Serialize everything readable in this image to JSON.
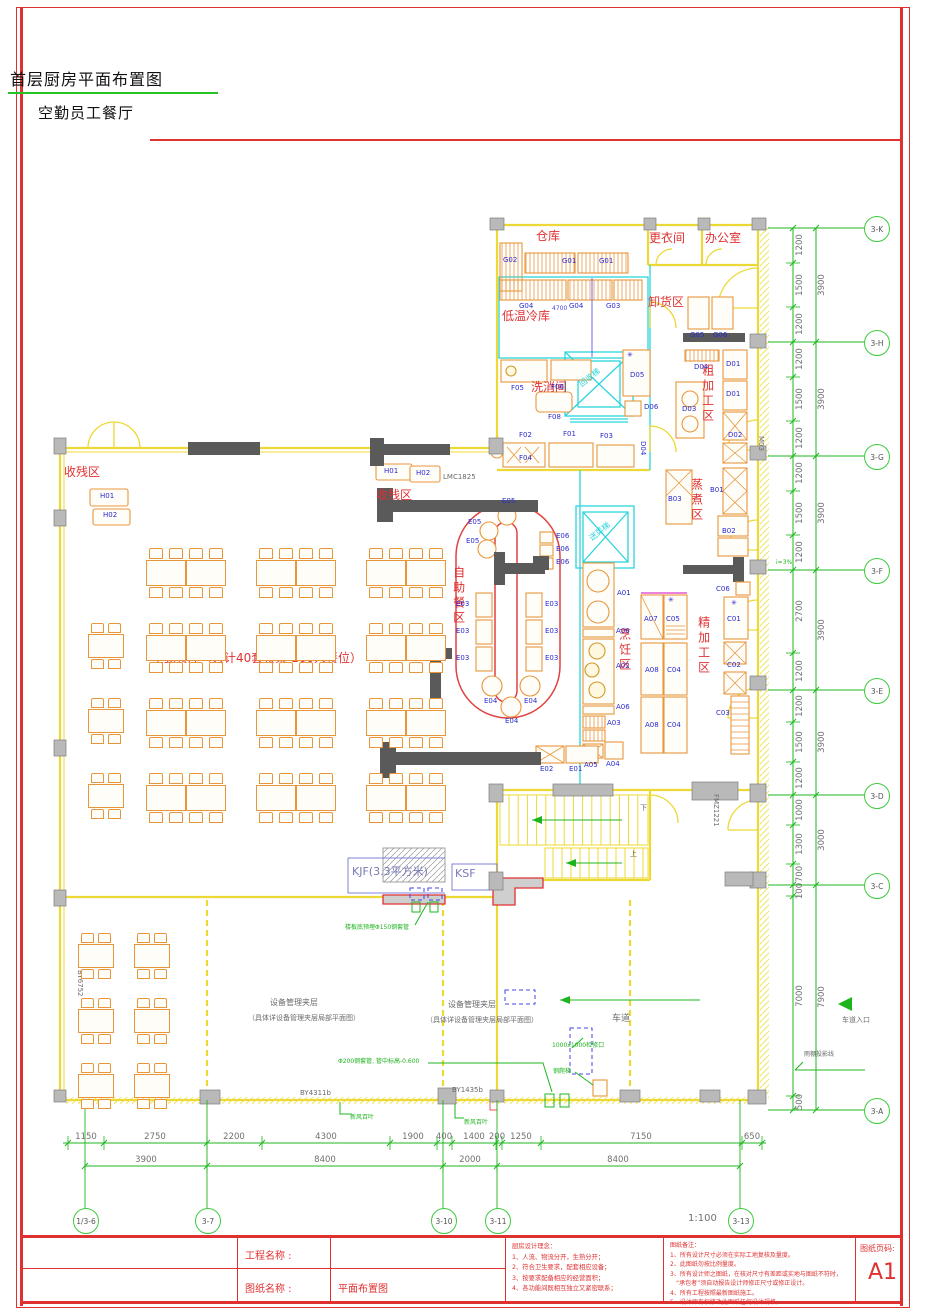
{
  "page": {
    "title": "首层厨房平面布置图",
    "subtitle": "空勤员工餐厅",
    "scale": "1:100"
  },
  "colors": {
    "wall": "#ecd936",
    "partition": "#2ad5dd",
    "furniture": "#e8963c",
    "zone_text": "#e03131",
    "code_text": "#2a2ad0",
    "dims": "#1db51d",
    "frame": "#e03131"
  },
  "zones": [
    {
      "label": "仓库",
      "x": 536,
      "y": 230,
      "dir": "h"
    },
    {
      "label": "更衣间",
      "x": 649,
      "y": 232,
      "dir": "h"
    },
    {
      "label": "办公室",
      "x": 705,
      "y": 232,
      "dir": "h"
    },
    {
      "label": "卸货区",
      "x": 648,
      "y": 296,
      "dir": "h"
    },
    {
      "label": "低温冷库",
      "x": 502,
      "y": 310,
      "dir": "h"
    },
    {
      "label": "洗消间",
      "x": 531,
      "y": 381,
      "dir": "h"
    },
    {
      "label": "收残区",
      "x": 64,
      "y": 466,
      "dir": "h"
    },
    {
      "label": "收残区",
      "x": 376,
      "y": 489,
      "dir": "h"
    },
    {
      "label": "自助餐区",
      "x": 452,
      "y": 566,
      "dir": "v"
    },
    {
      "label": "烹饪区",
      "x": 618,
      "y": 628,
      "dir": "v"
    },
    {
      "label": "蒸煮区",
      "x": 690,
      "y": 478,
      "dir": "v"
    },
    {
      "label": "精加工区",
      "x": 697,
      "y": 616,
      "dir": "v"
    },
    {
      "label": "粗加工区",
      "x": 701,
      "y": 364,
      "dir": "v"
    },
    {
      "label": "空勤餐厅（共计40套餐桌  160人餐位）",
      "x": 152,
      "y": 652,
      "dir": "h"
    }
  ],
  "equipment_codes": [
    {
      "code": "G02",
      "x": 503,
      "y": 257
    },
    {
      "code": "G01",
      "x": 562,
      "y": 258
    },
    {
      "code": "G01",
      "x": 599,
      "y": 258
    },
    {
      "code": "G04",
      "x": 519,
      "y": 303
    },
    {
      "code": "G04",
      "x": 569,
      "y": 303
    },
    {
      "code": "G03",
      "x": 606,
      "y": 303
    },
    {
      "code": "G05",
      "x": 690,
      "y": 332
    },
    {
      "code": "G06",
      "x": 713,
      "y": 332
    },
    {
      "code": "F05",
      "x": 511,
      "y": 385
    },
    {
      "code": "F06",
      "x": 551,
      "y": 384
    },
    {
      "code": "F08",
      "x": 548,
      "y": 414
    },
    {
      "code": "F02",
      "x": 519,
      "y": 432
    },
    {
      "code": "F01",
      "x": 563,
      "y": 431
    },
    {
      "code": "F03",
      "x": 600,
      "y": 433
    },
    {
      "code": "F04",
      "x": 519,
      "y": 455
    },
    {
      "code": "D05",
      "x": 630,
      "y": 372
    },
    {
      "code": "D06",
      "x": 644,
      "y": 404
    },
    {
      "code": "D04",
      "x": 694,
      "y": 364
    },
    {
      "code": "D03",
      "x": 682,
      "y": 406
    },
    {
      "code": "D01",
      "x": 726,
      "y": 361
    },
    {
      "code": "D01",
      "x": 726,
      "y": 391
    },
    {
      "code": "D02",
      "x": 728,
      "y": 432
    },
    {
      "code": "D04",
      "x": 639,
      "y": 441,
      "dir": "v"
    },
    {
      "code": "B03",
      "x": 668,
      "y": 496
    },
    {
      "code": "B01",
      "x": 710,
      "y": 487
    },
    {
      "code": "B02",
      "x": 722,
      "y": 528
    },
    {
      "code": "C06",
      "x": 716,
      "y": 586
    },
    {
      "code": "C01",
      "x": 727,
      "y": 616
    },
    {
      "code": "C02",
      "x": 727,
      "y": 662
    },
    {
      "code": "C03",
      "x": 716,
      "y": 710
    },
    {
      "code": "C05",
      "x": 666,
      "y": 616
    },
    {
      "code": "A07",
      "x": 644,
      "y": 616
    },
    {
      "code": "A08",
      "x": 645,
      "y": 667
    },
    {
      "code": "C04",
      "x": 667,
      "y": 667
    },
    {
      "code": "A08",
      "x": 645,
      "y": 722
    },
    {
      "code": "C04",
      "x": 667,
      "y": 722
    },
    {
      "code": "A01",
      "x": 617,
      "y": 590
    },
    {
      "code": "A06",
      "x": 616,
      "y": 628
    },
    {
      "code": "A02",
      "x": 616,
      "y": 663
    },
    {
      "code": "A06",
      "x": 616,
      "y": 704
    },
    {
      "code": "A03",
      "x": 607,
      "y": 720
    },
    {
      "code": "A05",
      "x": 584,
      "y": 762
    },
    {
      "code": "A04",
      "x": 606,
      "y": 761
    },
    {
      "code": "E05",
      "x": 502,
      "y": 498
    },
    {
      "code": "E05",
      "x": 468,
      "y": 519
    },
    {
      "code": "E05",
      "x": 466,
      "y": 538
    },
    {
      "code": "E06",
      "x": 556,
      "y": 533
    },
    {
      "code": "E06",
      "x": 556,
      "y": 546
    },
    {
      "code": "E06",
      "x": 556,
      "y": 559
    },
    {
      "code": "E03",
      "x": 456,
      "y": 601
    },
    {
      "code": "E03",
      "x": 456,
      "y": 628
    },
    {
      "code": "E03",
      "x": 456,
      "y": 655
    },
    {
      "code": "E03",
      "x": 545,
      "y": 601
    },
    {
      "code": "E03",
      "x": 545,
      "y": 628
    },
    {
      "code": "E03",
      "x": 545,
      "y": 655
    },
    {
      "code": "E04",
      "x": 484,
      "y": 698
    },
    {
      "code": "E04",
      "x": 524,
      "y": 698
    },
    {
      "code": "E04",
      "x": 505,
      "y": 718
    },
    {
      "code": "E02",
      "x": 540,
      "y": 766
    },
    {
      "code": "E01",
      "x": 569,
      "y": 766
    },
    {
      "code": "H01",
      "x": 100,
      "y": 493
    },
    {
      "code": "H02",
      "x": 103,
      "y": 512
    },
    {
      "code": "H01",
      "x": 384,
      "y": 468
    },
    {
      "code": "H02",
      "x": 416,
      "y": 470
    }
  ],
  "annotations": [
    {
      "t": "LMC1825",
      "x": 443,
      "y": 474,
      "c": "#6a6a6a",
      "s": 7
    },
    {
      "t": "M03",
      "x": 757,
      "y": 436,
      "c": "#6a6a6a",
      "s": 7,
      "dir": "v"
    },
    {
      "t": "FMZ1221",
      "x": 712,
      "y": 794,
      "c": "#6a6a6a",
      "s": 7,
      "dir": "v"
    },
    {
      "t": "BY6752",
      "x": 76,
      "y": 970,
      "c": "#6a6a6a",
      "s": 7,
      "dir": "v"
    },
    {
      "t": "BY4311b",
      "x": 300,
      "y": 1090,
      "c": "#6a6a6a",
      "s": 7
    },
    {
      "t": "BY1435b",
      "x": 452,
      "y": 1087,
      "c": "#6a6a6a",
      "s": 7
    },
    {
      "t": "KJF(3.3平方米)",
      "x": 352,
      "y": 866,
      "c": "#7878b8",
      "s": 11
    },
    {
      "t": "KSF",
      "x": 455,
      "y": 868,
      "c": "#7878b8",
      "s": 11
    },
    {
      "t": "回收梯",
      "x": 578,
      "y": 374,
      "c": "#2ad5dd",
      "s": 8,
      "rot": -38
    },
    {
      "t": "送菜梯",
      "x": 588,
      "y": 528,
      "c": "#2ad5dd",
      "s": 8,
      "rot": -38
    },
    {
      "t": "设备管理夹层",
      "x": 270,
      "y": 999,
      "c": "#6a6a6a",
      "s": 8
    },
    {
      "t": "（具体详设备管理夹层局部平面图）",
      "x": 248,
      "y": 1015,
      "c": "#6a6a6a",
      "s": 7
    },
    {
      "t": "设备管理夹层",
      "x": 448,
      "y": 1001,
      "c": "#6a6a6a",
      "s": 8
    },
    {
      "t": "（具体详设备管理夹层局部平面图）",
      "x": 426,
      "y": 1017,
      "c": "#6a6a6a",
      "s": 7
    },
    {
      "t": "车道",
      "x": 612,
      "y": 1015,
      "c": "#6a6a6a",
      "s": 9
    },
    {
      "t": "车道入口",
      "x": 842,
      "y": 1017,
      "c": "#6a6a6a",
      "s": 7
    },
    {
      "t": "雨棚投影线",
      "x": 804,
      "y": 1052,
      "c": "#6a6a6a",
      "s": 6
    },
    {
      "t": "楼板底预埋Φ150钢套管",
      "x": 345,
      "y": 925,
      "c": "#1db51d",
      "s": 6
    },
    {
      "t": "Φ200钢套管, 管中标高-0.600",
      "x": 338,
      "y": 1059,
      "c": "#1db51d",
      "s": 6
    },
    {
      "t": "1000x1000检修口",
      "x": 552,
      "y": 1043,
      "c": "#1db51d",
      "s": 6
    },
    {
      "t": "钢爬梯",
      "x": 553,
      "y": 1069,
      "c": "#1db51d",
      "s": 6
    },
    {
      "t": "新风百叶",
      "x": 350,
      "y": 1115,
      "c": "#1db51d",
      "s": 6
    },
    {
      "t": "新风百叶",
      "x": 464,
      "y": 1120,
      "c": "#1db51d",
      "s": 6
    },
    {
      "t": "下",
      "x": 640,
      "y": 805,
      "c": "#6a6a6a",
      "s": 7
    },
    {
      "t": "上",
      "x": 630,
      "y": 851,
      "c": "#6a6a6a",
      "s": 7
    },
    {
      "t": "i=3%",
      "x": 776,
      "y": 560,
      "c": "#1db51d",
      "s": 6
    },
    {
      "t": "4700",
      "x": 552,
      "y": 306,
      "c": "#4444e8",
      "s": 6
    },
    {
      "t": "✳",
      "x": 668,
      "y": 597,
      "c": "#2a2ad0",
      "s": 7
    },
    {
      "t": "✳",
      "x": 731,
      "y": 600,
      "c": "#2a2ad0",
      "s": 7
    },
    {
      "t": "✳",
      "x": 627,
      "y": 352,
      "c": "#2a2ad0",
      "s": 7
    }
  ],
  "grid_bubbles": {
    "right": [
      {
        "label": "3-K",
        "y": 228
      },
      {
        "label": "3-H",
        "y": 342
      },
      {
        "label": "3-G",
        "y": 456
      },
      {
        "label": "3-F",
        "y": 570
      },
      {
        "label": "3-E",
        "y": 690
      },
      {
        "label": "3-D",
        "y": 795
      },
      {
        "label": "3-C",
        "y": 885
      },
      {
        "label": "3-A",
        "y": 1110
      }
    ],
    "bottom": [
      {
        "label": "1/3-6",
        "x": 85
      },
      {
        "label": "3-7",
        "x": 207
      },
      {
        "label": "3-10",
        "x": 443
      },
      {
        "label": "3-11",
        "x": 497
      },
      {
        "label": "3-13",
        "x": 740
      }
    ]
  },
  "dimensions": {
    "right_inner": [
      {
        "v": "1200",
        "y": 245
      },
      {
        "v": "1500",
        "y": 285
      },
      {
        "v": "1200",
        "y": 324
      },
      {
        "v": "1200",
        "y": 359
      },
      {
        "v": "1500",
        "y": 399
      },
      {
        "v": "1200",
        "y": 438
      },
      {
        "v": "1200",
        "y": 473
      },
      {
        "v": "1500",
        "y": 513
      },
      {
        "v": "1200",
        "y": 552
      },
      {
        "v": "2700",
        "y": 611
      },
      {
        "v": "1200",
        "y": 671
      },
      {
        "v": "1200",
        "y": 706
      },
      {
        "v": "1500",
        "y": 742
      },
      {
        "v": "1200",
        "y": 778
      },
      {
        "v": "1000",
        "y": 810
      },
      {
        "v": "1300",
        "y": 844
      },
      {
        "v": "700",
        "y": 874
      },
      {
        "v": "100",
        "y": 891
      },
      {
        "v": "7000",
        "y": 996
      },
      {
        "v": "500",
        "y": 1102
      }
    ],
    "right_outer": [
      {
        "v": "3900",
        "y": 285
      },
      {
        "v": "3900",
        "y": 399
      },
      {
        "v": "3900",
        "y": 513
      },
      {
        "v": "3900",
        "y": 630
      },
      {
        "v": "3900",
        "y": 742
      },
      {
        "v": "3000",
        "y": 840
      },
      {
        "v": "7900",
        "y": 997
      }
    ],
    "bottom_row1": [
      {
        "v": "1150",
        "x": 86
      },
      {
        "v": "2750",
        "x": 155
      },
      {
        "v": "2200",
        "x": 234
      },
      {
        "v": "4300",
        "x": 326
      },
      {
        "v": "1900",
        "x": 413
      },
      {
        "v": "400",
        "x": 444
      },
      {
        "v": "1400",
        "x": 474
      },
      {
        "v": "200",
        "x": 497
      },
      {
        "v": "1250",
        "x": 521
      },
      {
        "v": "7150",
        "x": 641
      },
      {
        "v": "650",
        "x": 752
      }
    ],
    "bottom_row2": [
      {
        "v": "3900",
        "x": 146
      },
      {
        "v": "8400",
        "x": 325
      },
      {
        "v": "2000",
        "x": 470
      },
      {
        "v": "8400",
        "x": 618
      }
    ]
  },
  "titleblock": {
    "project_label": "工程名称 :",
    "project_value": "",
    "drawing_label": "图纸名称 :",
    "drawing_value": "平面布置图",
    "philosophy_title": "厨房设计理念：",
    "philosophy": [
      "1、人流、物流分开，生熟分开；",
      "2、符合卫生要求，配套相应设备；",
      "3、按要求配备相应的经营面积；",
      "4、各功能间既相互独立又紧密联系；"
    ],
    "notes_title": "图纸备注：",
    "notes": [
      "1、所有设计尺寸必须在实际工地复核及量度。",
      "2、此图纸勿按比例量度。",
      "3、所有设计师之图纸，在核对尺寸有差距或实地与图纸不符时，",
      "　“承包者”须自动报告设计师修正尺寸或修正设计。",
      "4、所有工程按照最新图纸施工。",
      "5、设计师有权修改此图纸任何设计规格。"
    ],
    "page_label": "图纸页码:",
    "page_value": "A1"
  }
}
